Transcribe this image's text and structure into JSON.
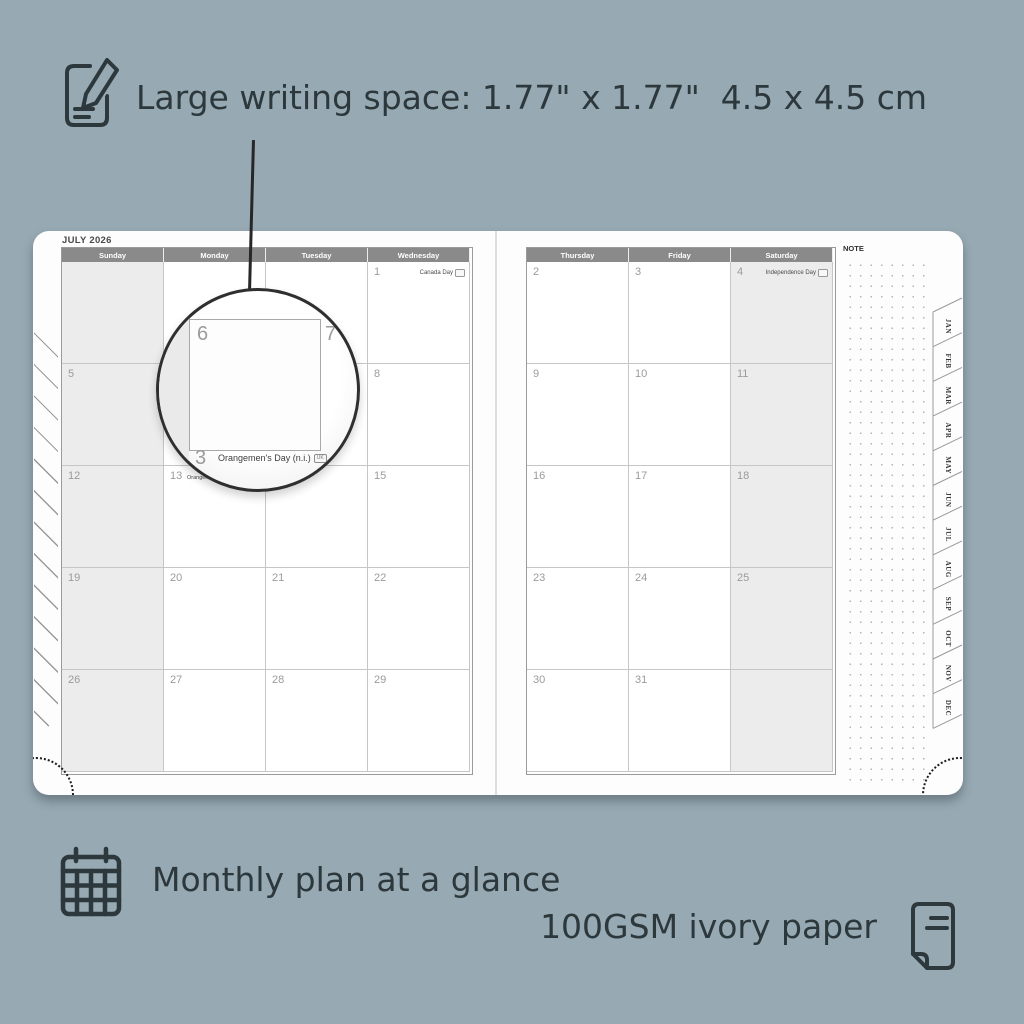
{
  "features": {
    "writing_space": "Large writing space: 1.77\" x 1.77\"  4.5 x 4.5 cm",
    "monthly_plan": "Monthly plan at a glance",
    "paper_quality": "100GSM ivory paper"
  },
  "planner": {
    "month_title": "JULY 2026",
    "note_label": "NOTE",
    "month_tabs": [
      "JAN",
      "FEB",
      "MAR",
      "APR",
      "MAY",
      "JUN",
      "JUL",
      "AUG",
      "SEP",
      "OCT",
      "NOV",
      "DEC"
    ],
    "left_page": {
      "headers": [
        "Sunday",
        "Monday",
        "Tuesday",
        "Wednesday"
      ],
      "shaded_column": 0,
      "weeks": [
        [
          {
            "d": ""
          },
          {
            "d": ""
          },
          {
            "d": ""
          },
          {
            "d": "1",
            "holiday": "Canada Day",
            "badge": "CA"
          }
        ],
        [
          {
            "d": "5"
          },
          {
            "d": "6"
          },
          {
            "d": "7"
          },
          {
            "d": "8"
          }
        ],
        [
          {
            "d": "12"
          },
          {
            "d": "13",
            "holiday": "Orangemen's Day (n.i.)",
            "badge": "UK",
            "holiday_pos": "left"
          },
          {
            "d": "14"
          },
          {
            "d": "15"
          }
        ],
        [
          {
            "d": "19"
          },
          {
            "d": "20"
          },
          {
            "d": "21"
          },
          {
            "d": "22"
          }
        ],
        [
          {
            "d": "26"
          },
          {
            "d": "27"
          },
          {
            "d": "28"
          },
          {
            "d": "29"
          }
        ]
      ]
    },
    "right_page": {
      "headers": [
        "Thursday",
        "Friday",
        "Saturday"
      ],
      "shaded_column": 2,
      "weeks": [
        [
          {
            "d": "2"
          },
          {
            "d": "3"
          },
          {
            "d": "4",
            "holiday": "Independence Day",
            "badge": "US"
          }
        ],
        [
          {
            "d": "9"
          },
          {
            "d": "10"
          },
          {
            "d": "11"
          }
        ],
        [
          {
            "d": "16"
          },
          {
            "d": "17"
          },
          {
            "d": "18"
          }
        ],
        [
          {
            "d": "23"
          },
          {
            "d": "24"
          },
          {
            "d": "25"
          }
        ],
        [
          {
            "d": "30"
          },
          {
            "d": "31"
          },
          {
            "d": ""
          }
        ]
      ]
    },
    "magnifier": {
      "cell_day": "6",
      "next_day": "7",
      "partial_day": "3",
      "holiday": "Orangemen's Day (n.i.)",
      "badge": "UK"
    }
  },
  "colors": {
    "background": "#97a9b3",
    "accent_text": "#2c383c",
    "header_bg": "#8a8a8a",
    "shaded_cell": "#ececec",
    "date_text": "#9b9b9b",
    "paper": "#fdfdfd"
  }
}
